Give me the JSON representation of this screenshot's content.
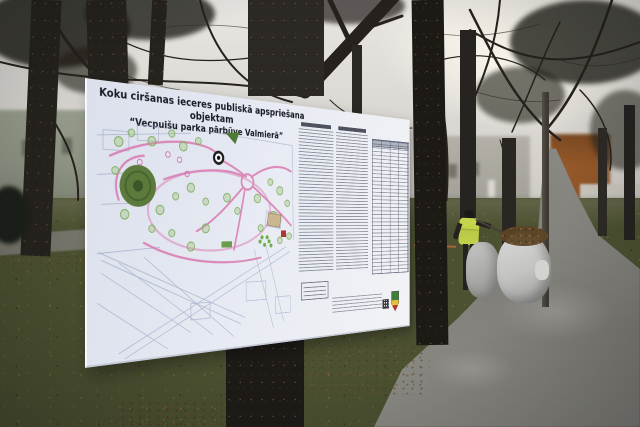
{
  "sign": {
    "title_line1": "Koku ciršanas ieceres publiskā apspriešana objektam",
    "title_line2": "“Vecpuišu parka pārbūve Valmierā”"
  },
  "colors": {
    "sign_paper": "#e8ebf3",
    "map_path_pink": "#d878b0",
    "map_tree_green": "#7fae5f",
    "hi_vis_vest": "#c3d24a",
    "leaf_bag_white": "#cfd0cd",
    "coat_of_arms_green": "#3f7d3a",
    "coat_of_arms_yellow": "#e0c23c",
    "coat_of_arms_red": "#b0342b"
  }
}
